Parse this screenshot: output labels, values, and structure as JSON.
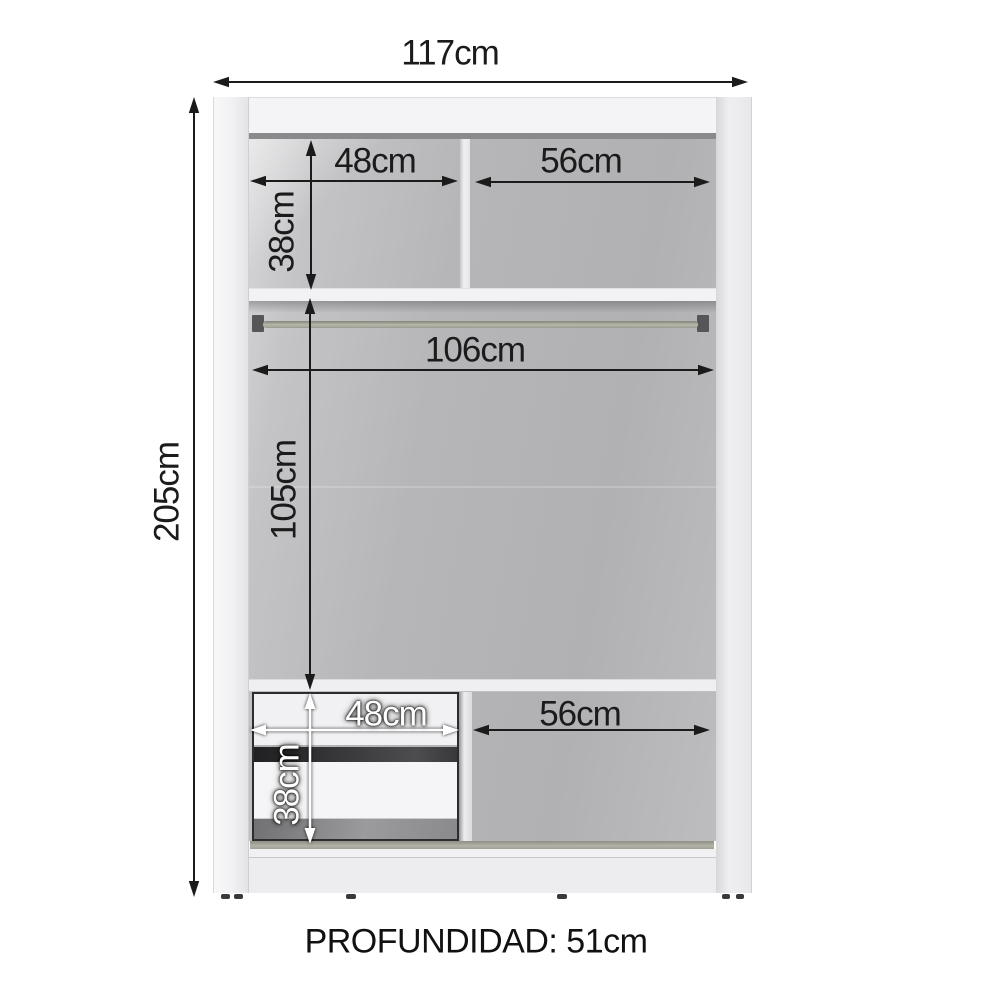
{
  "labels": {
    "overall_width": "117cm",
    "overall_height": "205cm",
    "top_left_compartment_width": "48cm",
    "top_right_compartment_width": "56cm",
    "top_compartment_height": "38cm",
    "rod_width": "106cm",
    "hanging_space_height": "105cm",
    "drawer_module_width": "48cm",
    "bottom_right_compartment_width": "56cm",
    "drawer_module_height": "38cm",
    "depth_note": "PROFUNDIDAD: 51cm"
  },
  "colors": {
    "annotation_dark": "#1b1b1b",
    "annotation_light": "#ffffff",
    "cabinet_shell": "#f0f0f2",
    "cabinet_interior": "#b4b4b6",
    "hanging_rod": "#a3a597",
    "background": "#ffffff"
  }
}
